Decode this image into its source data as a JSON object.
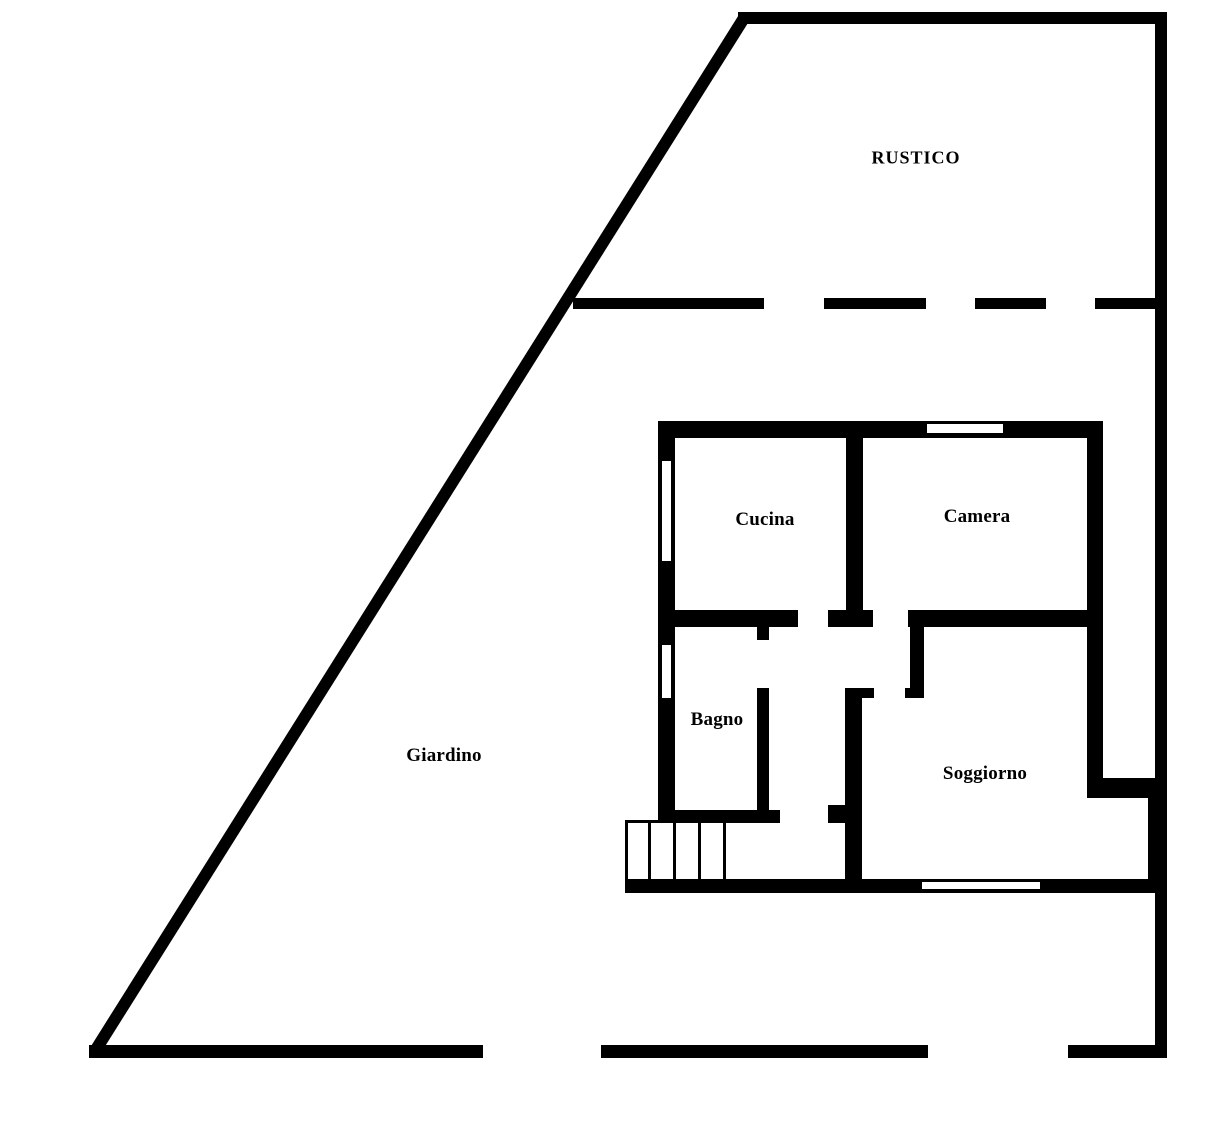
{
  "canvas": {
    "width": 1232,
    "height": 1123,
    "background_color": "#ffffff",
    "wall_color": "#000000",
    "window_color": "#ffffff"
  },
  "labels": {
    "rustico": {
      "text": "RUSTICO",
      "x": 916,
      "y": 158
    },
    "cucina": {
      "text": "Cucina",
      "x": 765,
      "y": 520
    },
    "camera": {
      "text": "Camera",
      "x": 977,
      "y": 517
    },
    "bagno": {
      "text": "Bagno",
      "x": 717,
      "y": 720
    },
    "soggiorno": {
      "text": "Soggiorno",
      "x": 985,
      "y": 774
    },
    "giardino": {
      "text": "Giardino",
      "x": 444,
      "y": 756
    }
  },
  "floorplan": {
    "boundary_walls": [
      {
        "name": "boundary-top",
        "x": 738,
        "y": 12,
        "w": 428,
        "h": 12
      },
      {
        "name": "boundary-right",
        "x": 1155,
        "y": 12,
        "w": 12,
        "h": 1046
      },
      {
        "name": "boundary-bottom-left",
        "x": 89,
        "y": 1045,
        "w": 394,
        "h": 13
      },
      {
        "name": "boundary-bottom-middle",
        "x": 601,
        "y": 1045,
        "w": 327,
        "h": 13
      },
      {
        "name": "boundary-bottom-right",
        "x": 1068,
        "y": 1045,
        "w": 99,
        "h": 13
      }
    ],
    "boundary_dashes": [
      {
        "name": "divider-dash-solid",
        "x": 573,
        "y": 298,
        "w": 191,
        "h": 11
      },
      {
        "name": "divider-dash-1",
        "x": 824,
        "y": 298,
        "w": 102,
        "h": 11
      },
      {
        "name": "divider-dash-2",
        "x": 975,
        "y": 298,
        "w": 71,
        "h": 11
      },
      {
        "name": "divider-dash-3",
        "x": 1095,
        "y": 298,
        "w": 65,
        "h": 11
      }
    ],
    "diagonal": {
      "name": "boundary-diagonal",
      "x1": 744,
      "y1": 18,
      "x2": 95,
      "y2": 1051,
      "thickness": 12
    },
    "house_walls": [
      {
        "name": "house-top-wall",
        "x": 658,
        "y": 421,
        "w": 444,
        "h": 17
      },
      {
        "name": "house-left-wall",
        "x": 658,
        "y": 421,
        "w": 17,
        "h": 402
      },
      {
        "name": "house-right-wall",
        "x": 1087,
        "y": 421,
        "w": 16,
        "h": 377
      },
      {
        "name": "house-notch-top-wall",
        "x": 1087,
        "y": 778,
        "w": 79,
        "h": 20
      },
      {
        "name": "house-notch-right-wall",
        "x": 1148,
        "y": 778,
        "w": 18,
        "h": 114
      },
      {
        "name": "house-bottom-wall",
        "x": 625,
        "y": 879,
        "w": 541,
        "h": 14
      },
      {
        "name": "cucina-camera-divider",
        "x": 846,
        "y": 438,
        "w": 17,
        "h": 189
      },
      {
        "name": "cucina-bottom-wall",
        "x": 675,
        "y": 610,
        "w": 123,
        "h": 17
      },
      {
        "name": "corridor-cross-stub",
        "x": 828,
        "y": 610,
        "w": 45,
        "h": 17
      },
      {
        "name": "camera-bottom-wall",
        "x": 908,
        "y": 610,
        "w": 179,
        "h": 17
      },
      {
        "name": "bagno-right-wall-upper",
        "x": 757,
        "y": 627,
        "w": 12,
        "h": 13
      },
      {
        "name": "bagno-right-wall-lower",
        "x": 757,
        "y": 688,
        "w": 12,
        "h": 122
      },
      {
        "name": "central-wall",
        "x": 845,
        "y": 688,
        "w": 17,
        "h": 191
      },
      {
        "name": "central-wall-stub",
        "x": 862,
        "y": 688,
        "w": 12,
        "h": 10
      },
      {
        "name": "soggiorno-left-wall",
        "x": 910,
        "y": 627,
        "w": 14,
        "h": 71
      },
      {
        "name": "soggiorno-left-foot",
        "x": 905,
        "y": 688,
        "w": 19,
        "h": 10
      },
      {
        "name": "bagno-bottom-wall",
        "x": 658,
        "y": 810,
        "w": 122,
        "h": 13
      },
      {
        "name": "stairs-landing-stub",
        "x": 828,
        "y": 805,
        "w": 17,
        "h": 18
      }
    ],
    "windows": [
      {
        "name": "window-camera-top",
        "x": 927,
        "y": 424,
        "w": 76,
        "h": 9
      },
      {
        "name": "window-cucina-left",
        "x": 662,
        "y": 461,
        "w": 9,
        "h": 100
      },
      {
        "name": "window-bagno-left",
        "x": 662,
        "y": 645,
        "w": 9,
        "h": 53
      },
      {
        "name": "window-soggiorno-bottom",
        "x": 922,
        "y": 882,
        "w": 118,
        "h": 7
      }
    ],
    "stairs": {
      "lines": [
        {
          "name": "stairs-top-edge",
          "x": 625,
          "y": 820,
          "w": 36,
          "h": 3
        },
        {
          "name": "stairs-left-edge",
          "x": 625,
          "y": 820,
          "w": 3,
          "h": 66
        },
        {
          "name": "stairs-tread-1",
          "x": 648,
          "y": 822,
          "w": 3,
          "h": 57
        },
        {
          "name": "stairs-tread-2",
          "x": 673,
          "y": 822,
          "w": 3,
          "h": 57
        },
        {
          "name": "stairs-tread-3",
          "x": 698,
          "y": 822,
          "w": 3,
          "h": 57
        },
        {
          "name": "stairs-tread-4",
          "x": 723,
          "y": 822,
          "w": 3,
          "h": 57
        }
      ]
    }
  }
}
